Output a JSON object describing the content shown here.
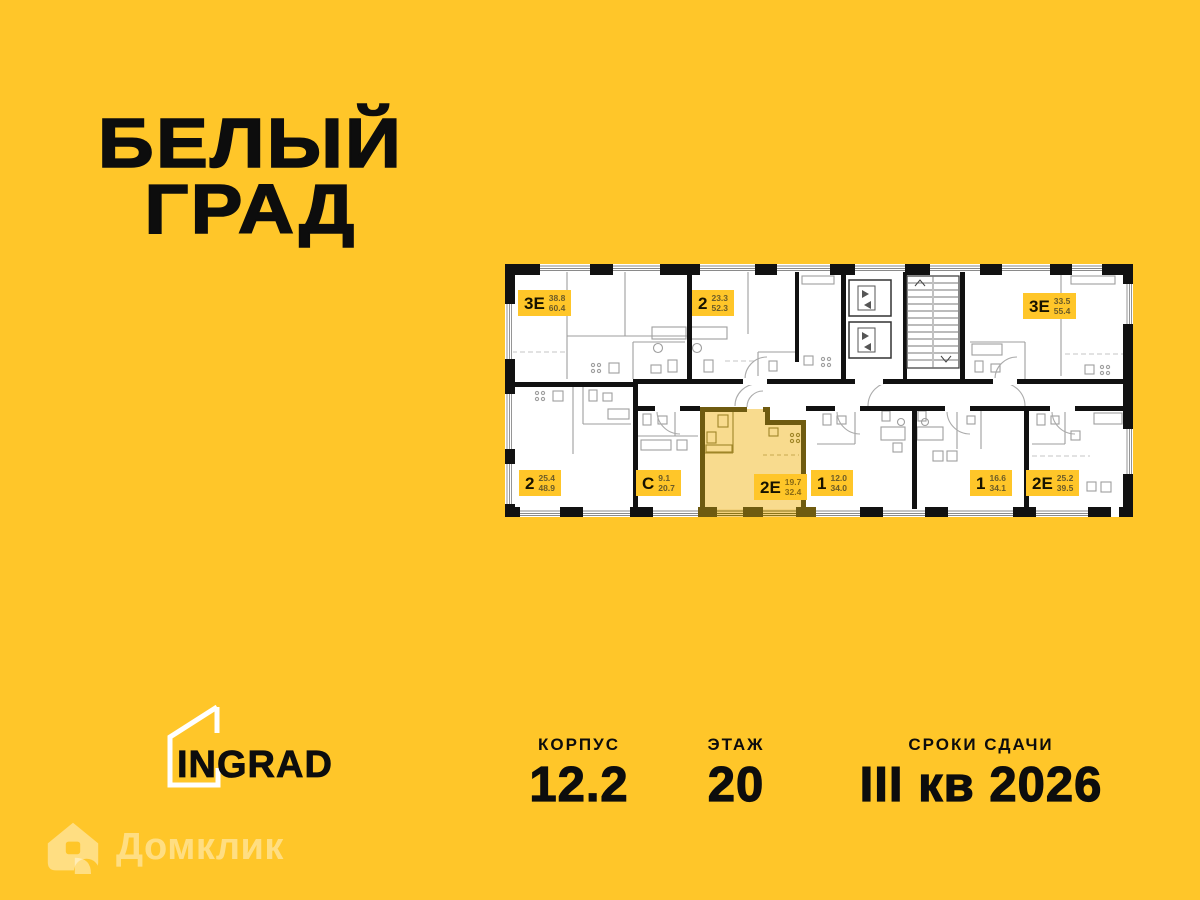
{
  "colors": {
    "background": "#FFC629",
    "ink": "#0d0d0d",
    "plan_floor": "#ffffff",
    "highlight_fill": "#F8DB8E",
    "highlight_wall": "#6F5B10",
    "badge_bg": "#FFC629",
    "badge_numbers": "#6b5b28",
    "watermark": "rgba(255,255,255,0.42)"
  },
  "title": {
    "line1": "БЕЛЫЙ",
    "line2": "ГРАД"
  },
  "plan": {
    "units": [
      {
        "type": "3Е",
        "area_living": "38.8",
        "area_total": "60.4",
        "highlighted": false
      },
      {
        "type": "2",
        "area_living": "23.3",
        "area_total": "52.3",
        "highlighted": false
      },
      {
        "type": "3Е",
        "area_living": "33.5",
        "area_total": "55.4",
        "highlighted": false
      },
      {
        "type": "2",
        "area_living": "25.4",
        "area_total": "48.9",
        "highlighted": false
      },
      {
        "type": "С",
        "area_living": "9.1",
        "area_total": "20.7",
        "highlighted": false
      },
      {
        "type": "2Е",
        "area_living": "19.7",
        "area_total": "32.4",
        "highlighted": true
      },
      {
        "type": "1",
        "area_living": "12.0",
        "area_total": "34.0",
        "highlighted": false
      },
      {
        "type": "1",
        "area_living": "16.6",
        "area_total": "34.1",
        "highlighted": false
      },
      {
        "type": "2Е",
        "area_living": "25.2",
        "area_total": "39.5",
        "highlighted": false
      }
    ]
  },
  "footer": {
    "logo": "INGRAD",
    "stats": [
      {
        "label": "КОРПУС",
        "value": "12.2"
      },
      {
        "label": "ЭТАЖ",
        "value": "20"
      },
      {
        "label": "СРОКИ СДАЧИ",
        "value": "III кв 2026"
      }
    ]
  },
  "watermark": {
    "text": "Домклик"
  }
}
